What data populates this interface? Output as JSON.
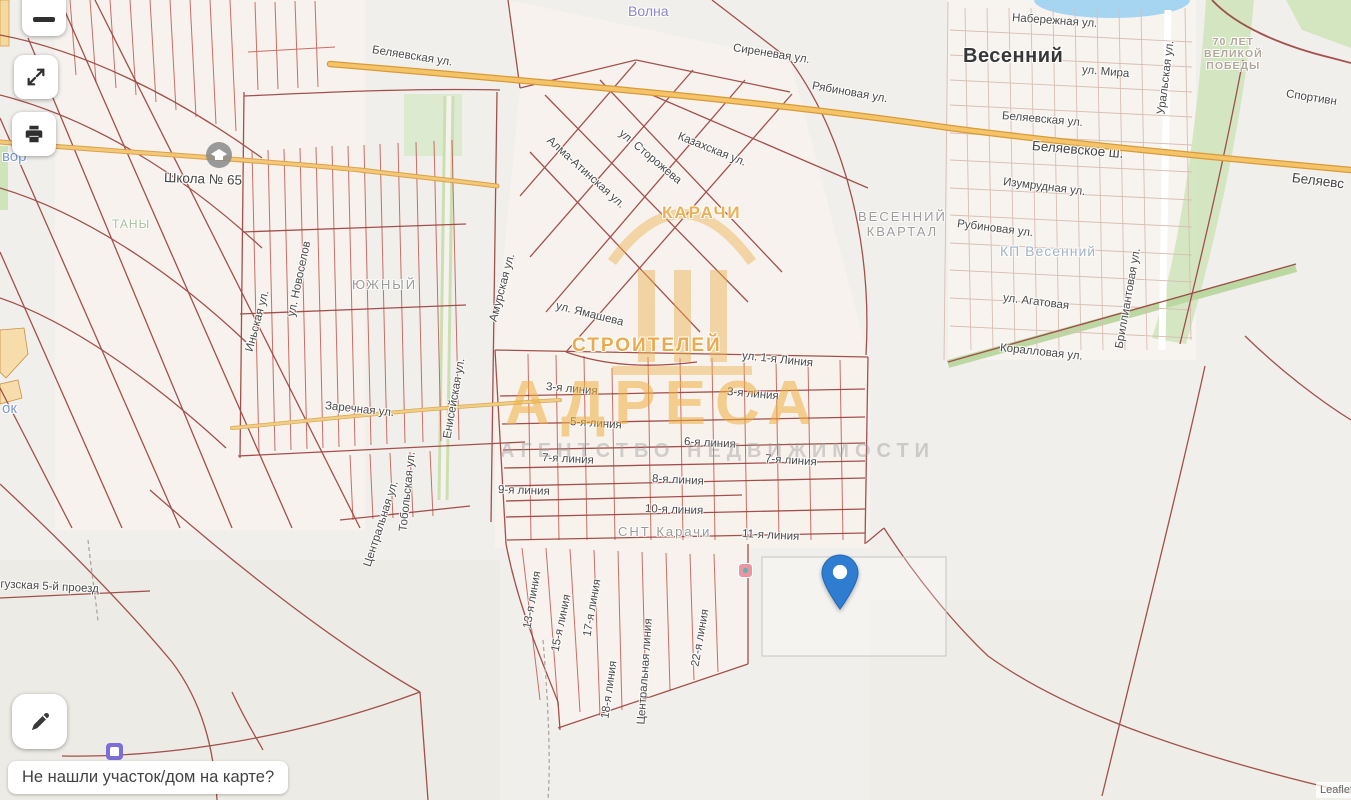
{
  "controls": {
    "footer_prompt": "Не нашли участок/дом на карте?"
  },
  "attribution": {
    "text": "Leaflet |"
  },
  "watermark": {
    "title": "АДРЕСА",
    "subtitle": "АГЕНТСТВО НЕДВИЖИМОСТИ"
  },
  "map": {
    "pin": {
      "color": "#2e7dd1",
      "tip_x": 840,
      "tip_y": 612
    },
    "colors": {
      "background": "#f1efeb",
      "main_road": "#f6c468",
      "parcel_line_dark": "#9a3f3c",
      "parcel_line_bright": "#c0584e",
      "green_area": "#cfe4ba",
      "water": "#a6d5f2",
      "watermark_orange": "#eeae3e"
    },
    "labels": [
      {
        "t": "Волна",
        "x": 628,
        "y": 3,
        "r": 0,
        "c": "purple"
      },
      {
        "t": "Сиреневая ул.",
        "x": 733,
        "y": 42,
        "r": 9,
        "c": "st"
      },
      {
        "t": "Рябиновая ул.",
        "x": 812,
        "y": 80,
        "r": 10,
        "c": "st"
      },
      {
        "t": "Набережная ул.",
        "x": 1012,
        "y": 12,
        "r": 4,
        "c": "st"
      },
      {
        "t": "Весенний",
        "x": 963,
        "y": 45,
        "r": 0,
        "c": "big"
      },
      {
        "t": "ул. Мира",
        "x": 1082,
        "y": 64,
        "r": 5,
        "c": "st"
      },
      {
        "t": "Уральская ул.",
        "x": 1162,
        "y": 108,
        "r": -83,
        "c": "st"
      },
      {
        "t": "70 ЛЕТ\nВЕЛИКОЙ\nПОБЕДЫ",
        "x": 1204,
        "y": 36,
        "r": 0,
        "c": "memo"
      },
      {
        "t": "Спортивн",
        "x": 1286,
        "y": 88,
        "r": 9,
        "c": "st"
      },
      {
        "t": "Беляевская ул.",
        "x": 1002,
        "y": 110,
        "r": 5,
        "c": "st"
      },
      {
        "t": "Беляевское ш.",
        "x": 1032,
        "y": 138,
        "r": 5,
        "c": "stb"
      },
      {
        "t": "Беляевс",
        "x": 1292,
        "y": 170,
        "r": 7,
        "c": "stb"
      },
      {
        "t": "Изумрудная ул.",
        "x": 1003,
        "y": 176,
        "r": 7,
        "c": "st"
      },
      {
        "t": "Рубиновая ул.",
        "x": 957,
        "y": 218,
        "r": 7,
        "c": "st"
      },
      {
        "t": "КП Весенний",
        "x": 1000,
        "y": 243,
        "r": 0,
        "c": "kp"
      },
      {
        "t": "Бриллиантовая ул.",
        "x": 1120,
        "y": 342,
        "r": -80,
        "c": "st"
      },
      {
        "t": "ул. Агатовая",
        "x": 1003,
        "y": 292,
        "r": 7,
        "c": "st"
      },
      {
        "t": "Коралловая ул.",
        "x": 1000,
        "y": 342,
        "r": 6,
        "c": "st"
      },
      {
        "t": "Беляевская ул.",
        "x": 372,
        "y": 44,
        "r": 9,
        "c": "st"
      },
      {
        "t": "Школа № 65",
        "x": 164,
        "y": 170,
        "r": 2,
        "c": "stb"
      },
      {
        "t": "ТАНЫ",
        "x": 112,
        "y": 218,
        "r": 0,
        "c": "grn"
      },
      {
        "t": "ЮЖНЫЙ",
        "x": 352,
        "y": 278,
        "r": 0,
        "c": "dist"
      },
      {
        "t": "Заречная ул.",
        "x": 325,
        "y": 400,
        "r": 6,
        "c": "st"
      },
      {
        "t": "вор",
        "x": 2,
        "y": 148,
        "r": 0,
        "c": "blue"
      },
      {
        "t": "ок",
        "x": 2,
        "y": 400,
        "r": 0,
        "c": "blue"
      },
      {
        "t": "нгузская 5-й проезд",
        "x": -6,
        "y": 578,
        "r": 3,
        "c": "st"
      },
      {
        "t": "ВЕСЕННИЙ\nКВАРТАЛ",
        "x": 858,
        "y": 210,
        "r": 0,
        "c": "dist center"
      },
      {
        "t": "КАРАЧИ",
        "x": 662,
        "y": 203,
        "r": 0,
        "c": "ghost18"
      },
      {
        "t": "СТРОИТЕЛЕЙ",
        "x": 572,
        "y": 335,
        "r": 0,
        "c": "ghost20"
      },
      {
        "t": "ул. Ямашева",
        "x": 556,
        "y": 300,
        "r": 14,
        "c": "st"
      },
      {
        "t": "Алма-Атинская ул.",
        "x": 548,
        "y": 133,
        "r": 42,
        "c": "st"
      },
      {
        "t": "ул. Сторожева",
        "x": 620,
        "y": 126,
        "r": 40,
        "c": "st"
      },
      {
        "t": "Казахская ул.",
        "x": 678,
        "y": 130,
        "r": 22,
        "c": "st"
      },
      {
        "t": "ул. 1-я Линия",
        "x": 742,
        "y": 350,
        "r": 6,
        "c": "st"
      },
      {
        "t": "3-я линия",
        "x": 546,
        "y": 381,
        "r": 5,
        "c": "st"
      },
      {
        "t": "3-я линия",
        "x": 727,
        "y": 386,
        "r": 5,
        "c": "st"
      },
      {
        "t": "5-я линия",
        "x": 570,
        "y": 416,
        "r": 4,
        "c": "st"
      },
      {
        "t": "6-я линия",
        "x": 684,
        "y": 436,
        "r": 3,
        "c": "st"
      },
      {
        "t": "7-я линия",
        "x": 542,
        "y": 452,
        "r": 3,
        "c": "st"
      },
      {
        "t": "7-я линия",
        "x": 765,
        "y": 453,
        "r": 4,
        "c": "st"
      },
      {
        "t": "8-я линия",
        "x": 652,
        "y": 473,
        "r": 3,
        "c": "st"
      },
      {
        "t": "9-я линия",
        "x": 498,
        "y": 484,
        "r": 2,
        "c": "st"
      },
      {
        "t": "10-я линия",
        "x": 645,
        "y": 503,
        "r": 2,
        "c": "st"
      },
      {
        "t": "СНТ Карачи",
        "x": 618,
        "y": 525,
        "r": 0,
        "c": "dist"
      },
      {
        "t": "11-я линия",
        "x": 742,
        "y": 528,
        "r": 3,
        "c": "st"
      },
      {
        "t": "13-я линия",
        "x": 528,
        "y": 622,
        "r": -80,
        "c": "st"
      },
      {
        "t": "15-я линия",
        "x": 556,
        "y": 645,
        "r": -78,
        "c": "st"
      },
      {
        "t": "17-я линия",
        "x": 588,
        "y": 630,
        "r": -80,
        "c": "st"
      },
      {
        "t": "18-я линия",
        "x": 606,
        "y": 712,
        "r": -82,
        "c": "st"
      },
      {
        "t": "Центральная линия",
        "x": 642,
        "y": 718,
        "r": -86,
        "c": "st"
      },
      {
        "t": "22-я линия",
        "x": 696,
        "y": 660,
        "r": -80,
        "c": "st"
      },
      {
        "t": "Амурская ул.",
        "x": 494,
        "y": 315,
        "r": -75,
        "c": "st"
      },
      {
        "t": "Енисейская ул.",
        "x": 448,
        "y": 432,
        "r": -80,
        "c": "st"
      },
      {
        "t": "Тобольская ул.",
        "x": 404,
        "y": 525,
        "r": -84,
        "c": "st"
      },
      {
        "t": "Центральная ул.",
        "x": 368,
        "y": 560,
        "r": -72,
        "c": "st"
      },
      {
        "t": "Иньская ул.",
        "x": 250,
        "y": 345,
        "r": -75,
        "c": "st"
      },
      {
        "t": "ул. Новоселов",
        "x": 292,
        "y": 310,
        "r": -78,
        "c": "st"
      }
    ]
  }
}
